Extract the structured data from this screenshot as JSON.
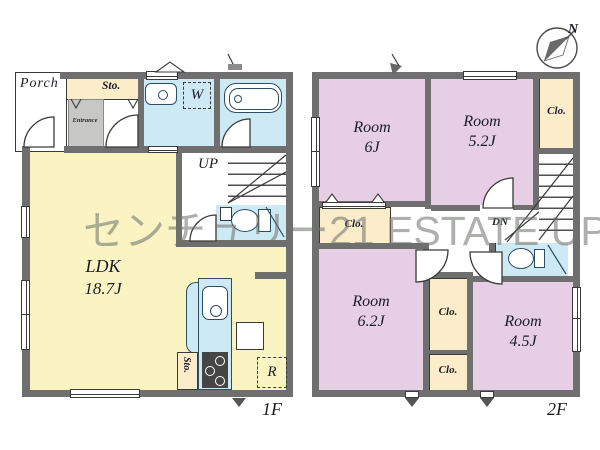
{
  "watermark": {
    "text": "センチュリー21 ESTATE UP"
  },
  "compass": {
    "north_label": "N"
  },
  "floor1": {
    "label": "1F",
    "porch": "Porch",
    "storage_top": "Sto.",
    "entrance": "Entrance",
    "washing_machine": "W",
    "stairs_up": "UP",
    "ldk": {
      "name": "LDK",
      "size": "18.7J"
    },
    "storage_kitchen": "Sto.",
    "refrigerator": "R"
  },
  "floor2": {
    "label": "2F",
    "stairs_down": "DN",
    "room_6j": {
      "name": "Room",
      "size": "6J"
    },
    "room_5_2j": {
      "name": "Room",
      "size": "5.2J"
    },
    "room_6_2j": {
      "name": "Room",
      "size": "6.2J"
    },
    "room_4_5j": {
      "name": "Room",
      "size": "4.5J"
    },
    "closet_top_right": "Clo.",
    "closet_6j": "Clo.",
    "closet_mid_upper": "Clo.",
    "closet_mid_lower": "Clo."
  },
  "colors": {
    "wall": "#6f6f6f",
    "ldk_yellow": "#f9f4c2",
    "room_pink": "#e6cee4",
    "water_blue": "#cde9f4",
    "closet_cream": "#fcedca",
    "entrance_gray": "#c7c7c6",
    "watermark_gray": "#6d716d"
  }
}
